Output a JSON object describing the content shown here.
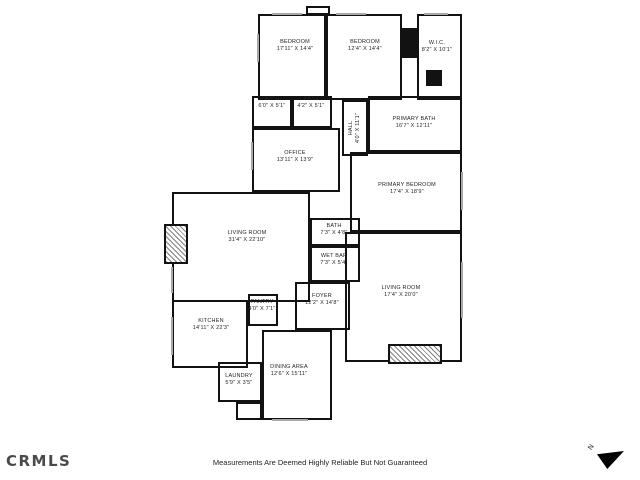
{
  "footer": {
    "logo_text": "CRMLS",
    "disclaimer": "Measurements Are Deemed Highly Reliable But Not Guaranteed",
    "compass_label": "N"
  },
  "colors": {
    "wall": "#121212",
    "label": "#1f1f1f",
    "window": "#a9a9a9",
    "logo": "#4a4a4a"
  },
  "plan": {
    "rooms": [
      {
        "id": "bedroom-1",
        "name": "BEDROOM",
        "dims": "17'11\" X 14'4\"",
        "box": [
          258,
          14,
          68,
          86
        ],
        "label": [
          295,
          46
        ]
      },
      {
        "id": "bedroom-2",
        "name": "BEDROOM",
        "dims": "12'4\" X 14'4\"",
        "box": [
          326,
          14,
          76,
          86
        ],
        "label": [
          365,
          46
        ]
      },
      {
        "id": "wic",
        "name": "W.I.C.",
        "dims": "8'2\" X 10'1\"",
        "box": [
          417,
          14,
          45,
          86
        ],
        "label": [
          437,
          47
        ]
      },
      {
        "id": "bath-1",
        "name": "BATH",
        "dims": "6'0\" X 5'1\"",
        "box": [
          252,
          96,
          40,
          32
        ],
        "label": [
          272,
          103
        ]
      },
      {
        "id": "bath-2",
        "name": "BATH",
        "dims": "4'2\" X 5'1\"",
        "box": [
          292,
          96,
          40,
          32
        ],
        "label": [
          311,
          103
        ]
      },
      {
        "id": "office",
        "name": "OFFICE",
        "dims": "13'11\" X 13'9\"",
        "box": [
          252,
          128,
          88,
          64
        ],
        "label": [
          295,
          157
        ]
      },
      {
        "id": "hall",
        "name": "HALL",
        "dims": "4'0\" X 11'1\"",
        "box": [
          342,
          100,
          26,
          56
        ],
        "label": [
          355,
          128
        ],
        "vertical": true
      },
      {
        "id": "primary-bath",
        "name": "PRIMARY BATH",
        "dims": "16'7\" X 12'11\"",
        "box": [
          368,
          96,
          94,
          56
        ],
        "label": [
          414,
          123
        ]
      },
      {
        "id": "primary-bedroom",
        "name": "PRIMARY BEDROOM",
        "dims": "17'4\" X 18'9\"",
        "box": [
          350,
          152,
          112,
          80
        ],
        "label": [
          407,
          189
        ]
      },
      {
        "id": "living-room-1",
        "name": "LIVING ROOM",
        "dims": "31'4\" X 22'10\"",
        "box": [
          172,
          192,
          138,
          110
        ],
        "label": [
          247,
          237
        ]
      },
      {
        "id": "bath-3",
        "name": "BATH",
        "dims": "7'3\" X 4'8\"",
        "box": [
          310,
          218,
          50,
          28
        ],
        "label": [
          334,
          230
        ]
      },
      {
        "id": "wet-bar",
        "name": "WET BAR",
        "dims": "7'3\" X 5'4\"",
        "box": [
          310,
          246,
          50,
          36
        ],
        "label": [
          334,
          260
        ]
      },
      {
        "id": "foyer",
        "name": "FOYER",
        "dims": "12'2\" X 14'8\"",
        "box": [
          295,
          282,
          55,
          48
        ],
        "label": [
          322,
          300
        ]
      },
      {
        "id": "living-room-2",
        "name": "LIVING ROOM",
        "dims": "17'4\" X 20'0\"",
        "box": [
          345,
          232,
          117,
          130
        ],
        "label": [
          401,
          292
        ]
      },
      {
        "id": "pantry",
        "name": "PANTRY",
        "dims": "4'0\" X 7'1\"",
        "box": [
          248,
          294,
          30,
          32
        ],
        "label": [
          262,
          306
        ]
      },
      {
        "id": "kitchen",
        "name": "KITCHEN",
        "dims": "14'11\" X 22'3\"",
        "box": [
          172,
          300,
          76,
          68
        ],
        "label": [
          211,
          325
        ]
      },
      {
        "id": "laundry",
        "name": "LAUNDRY",
        "dims": "5'9\" X 3'5\"",
        "box": [
          218,
          362,
          44,
          40
        ],
        "label": [
          239,
          380
        ]
      },
      {
        "id": "dining-area",
        "name": "DINING AREA",
        "dims": "12'6\" X 15'11\"",
        "box": [
          262,
          330,
          70,
          90
        ],
        "label": [
          289,
          371
        ]
      }
    ],
    "features": [
      {
        "id": "fireplace-left",
        "kind": "hatched",
        "box": [
          164,
          224,
          24,
          40
        ]
      },
      {
        "id": "fireplace-right",
        "kind": "hatched",
        "box": [
          388,
          344,
          54,
          20
        ]
      },
      {
        "id": "solid-chase-top",
        "kind": "solid",
        "box": [
          402,
          28,
          15,
          30
        ]
      },
      {
        "id": "solid-chase-wic",
        "kind": "solid",
        "box": [
          426,
          70,
          16,
          16
        ]
      },
      {
        "id": "chimney-top",
        "kind": "outline",
        "box": [
          306,
          6,
          24,
          9
        ]
      },
      {
        "id": "closet-nook",
        "kind": "outline",
        "box": [
          236,
          402,
          26,
          18
        ]
      }
    ],
    "windows": [
      {
        "box": [
          272,
          13,
          30,
          2
        ]
      },
      {
        "box": [
          336,
          13,
          30,
          2
        ]
      },
      {
        "box": [
          424,
          13,
          24,
          2
        ]
      },
      {
        "box": [
          257,
          34,
          2,
          28
        ]
      },
      {
        "box": [
          251,
          142,
          2,
          28
        ]
      },
      {
        "box": [
          171,
          267,
          2,
          26
        ]
      },
      {
        "box": [
          171,
          317,
          2,
          38
        ]
      },
      {
        "box": [
          461,
          172,
          2,
          38
        ]
      },
      {
        "box": [
          461,
          262,
          2,
          56
        ]
      },
      {
        "box": [
          272,
          419,
          36,
          2
        ]
      }
    ]
  }
}
